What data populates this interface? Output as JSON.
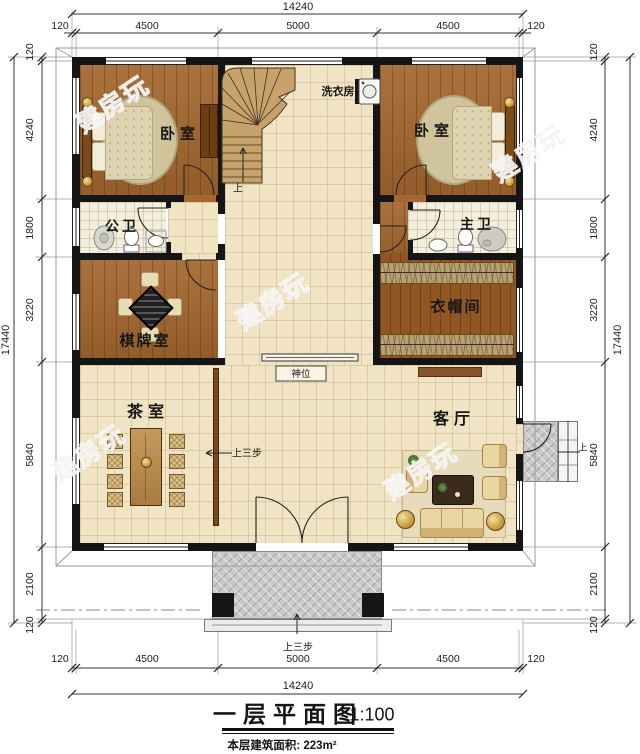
{
  "watermark": "建房玩",
  "title": {
    "text": "一层平面图",
    "scale": "1:100",
    "area": "本层建筑面积: 223m²"
  },
  "rooms": {
    "bedroom_left": "卧室",
    "bedroom_right": "卧室",
    "laundry": "洗衣房",
    "public_bath": "公卫",
    "master_bath": "主卫",
    "chess_room": "棋牌室",
    "cloakroom": "衣帽间",
    "tea_room": "茶室",
    "living_room": "客厅",
    "shrine": "神位"
  },
  "annotations": {
    "up": "上",
    "up_three_steps": "上三步"
  },
  "dims": {
    "overall_width": "14240",
    "overall_height": "17440",
    "top": [
      "120",
      "4500",
      "5000",
      "4500",
      "120"
    ],
    "bottom": [
      "120",
      "4500",
      "5000",
      "4500",
      "120"
    ],
    "left": [
      "120",
      "4240",
      "1800",
      "3220",
      "5840",
      "2100",
      "120"
    ],
    "right": [
      "120",
      "4240",
      "1800",
      "3220",
      "5840",
      "2100",
      "120"
    ]
  },
  "colors": {
    "wall": "#151515",
    "wood_floor": "#a3672f",
    "tile_floor": "#f0e4c4",
    "porch": "#c9c9c9"
  }
}
